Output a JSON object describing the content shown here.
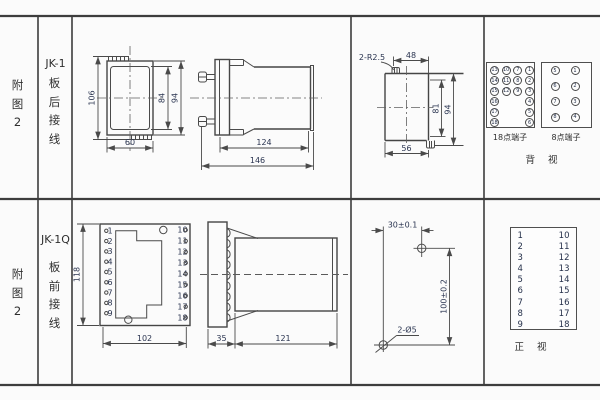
{
  "rows": [
    {
      "figure_label": "附图2",
      "model": "JK-1",
      "wiring": "板后接线",
      "front_view": {
        "dim_total_height": "106",
        "dim_inner_height": "84",
        "dim_outer_height": "94",
        "dim_width": "60"
      },
      "side_view": {
        "dim_body_depth": "124",
        "dim_total_depth": "146"
      },
      "cutout_view": {
        "corner_note": "2-R2.5",
        "dim_top_width": "48",
        "dim_inner_height": "81",
        "dim_outer_height": "94",
        "dim_bottom_width": "56"
      },
      "rear_terminals": {
        "block18_label": "18点端子",
        "block8_label": "8点端子",
        "caption": "背 视",
        "block18_rows": [
          [
            "13",
            "10",
            "7",
            "1"
          ],
          [
            "14",
            "11",
            "8",
            "2"
          ],
          [
            "15",
            "12",
            "9",
            "3"
          ],
          [
            "16",
            "",
            "",
            "4"
          ],
          [
            "17",
            "",
            "",
            "5"
          ],
          [
            "18",
            "",
            "",
            "6"
          ]
        ],
        "block8_rows": [
          [
            "5",
            "1"
          ],
          [
            "6",
            "2"
          ],
          [
            "7",
            "3"
          ],
          [
            "8",
            "4"
          ]
        ]
      }
    },
    {
      "figure_label": "附图2",
      "model": "JK-1Q",
      "wiring": "板前接线",
      "front_view": {
        "dim_height": "118",
        "dim_width": "102",
        "left_terminals": [
          "1",
          "2",
          "3",
          "4",
          "5",
          "6",
          "7",
          "8",
          "9"
        ],
        "right_terminals": [
          "10",
          "11",
          "12",
          "13",
          "14",
          "15",
          "16",
          "17",
          "18"
        ]
      },
      "side_view": {
        "dim_plate_depth": "35",
        "dim_body_depth": "121"
      },
      "drill_view": {
        "dim_horizontal": "30±0.1",
        "dim_vertical": "100±0.2",
        "hole_note": "2-Ø5"
      },
      "front_table": {
        "left_col": [
          "1",
          "2",
          "3",
          "4",
          "5",
          "6",
          "7",
          "8",
          "9"
        ],
        "right_col": [
          "10",
          "11",
          "12",
          "13",
          "14",
          "15",
          "16",
          "17",
          "18"
        ],
        "caption": "正 视"
      }
    }
  ]
}
